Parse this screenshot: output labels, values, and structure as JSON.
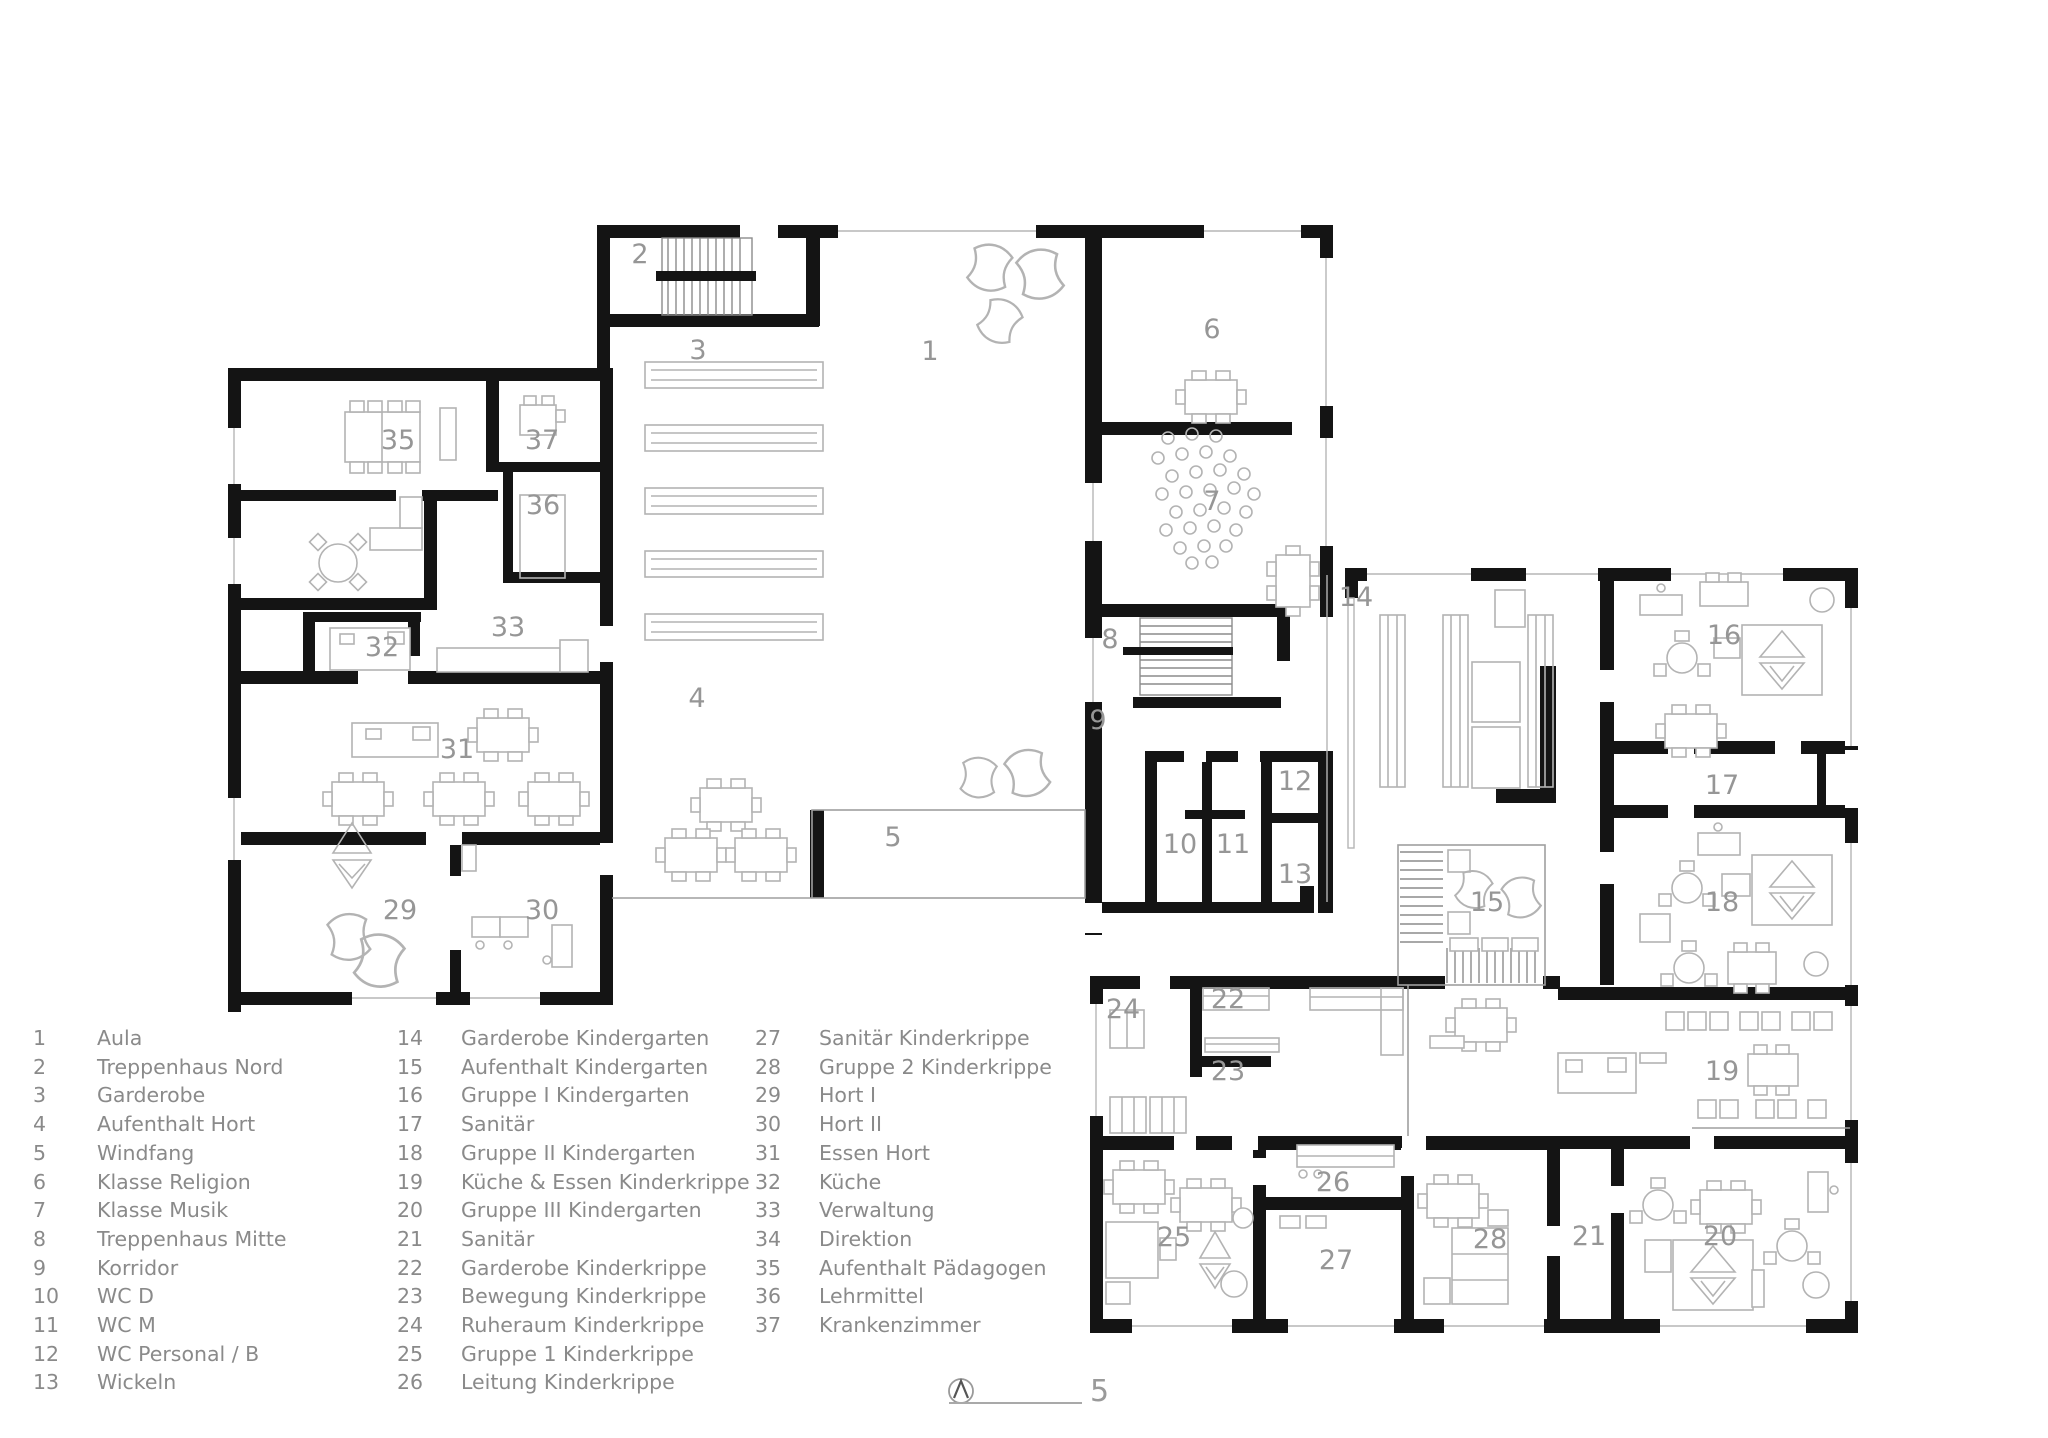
{
  "colors": {
    "wall": "#141414",
    "furniture_line": "#b3b3b3",
    "room_label": "#969696",
    "legend_text": "#8a8a8a",
    "background": "#ffffff"
  },
  "legend": {
    "columns": [
      {
        "items": [
          {
            "num": "1",
            "label": "Aula"
          },
          {
            "num": "2",
            "label": "Treppenhaus Nord"
          },
          {
            "num": "3",
            "label": "Garderobe"
          },
          {
            "num": "4",
            "label": "Aufenthalt Hort"
          },
          {
            "num": "5",
            "label": "Windfang"
          },
          {
            "num": "6",
            "label": "Klasse Religion"
          },
          {
            "num": "7",
            "label": "Klasse Musik"
          },
          {
            "num": "8",
            "label": "Treppenhaus Mitte"
          },
          {
            "num": "9",
            "label": "Korridor"
          },
          {
            "num": "10",
            "label": "WC D"
          },
          {
            "num": "11",
            "label": "WC M"
          },
          {
            "num": "12",
            "label": "WC Personal / B"
          },
          {
            "num": "13",
            "label": "Wickeln"
          }
        ]
      },
      {
        "items": [
          {
            "num": "14",
            "label": "Garderobe Kindergarten"
          },
          {
            "num": "15",
            "label": "Aufenthalt Kindergarten"
          },
          {
            "num": "16",
            "label": "Gruppe I Kindergarten"
          },
          {
            "num": "17",
            "label": "Sanitär"
          },
          {
            "num": "18",
            "label": "Gruppe II Kindergarten"
          },
          {
            "num": "19",
            "label": "Küche & Essen Kinderkrippe"
          },
          {
            "num": "20",
            "label": "Gruppe III Kindergarten"
          },
          {
            "num": "21",
            "label": "Sanitär"
          },
          {
            "num": "22",
            "label": "Garderobe Kinderkrippe"
          },
          {
            "num": "23",
            "label": "Bewegung Kinderkrippe"
          },
          {
            "num": "24",
            "label": "Ruheraum Kinderkrippe"
          },
          {
            "num": "25",
            "label": "Gruppe 1 Kinderkrippe"
          },
          {
            "num": "26",
            "label": "Leitung Kinderkrippe"
          }
        ]
      },
      {
        "items": [
          {
            "num": "27",
            "label": "Sanitär Kinderkrippe"
          },
          {
            "num": "28",
            "label": "Gruppe 2 Kinderkrippe"
          },
          {
            "num": "29",
            "label": "Hort I"
          },
          {
            "num": "30",
            "label": "Hort II"
          },
          {
            "num": "31",
            "label": "Essen Hort"
          },
          {
            "num": "32",
            "label": "Küche"
          },
          {
            "num": "33",
            "label": "Verwaltung"
          },
          {
            "num": "34",
            "label": "Direktion"
          },
          {
            "num": "35",
            "label": "Aufenthalt Pädagogen"
          },
          {
            "num": "36",
            "label": "Lehrmittel"
          },
          {
            "num": "37",
            "label": "Krankenzimmer"
          }
        ]
      }
    ]
  },
  "plan": {
    "room_labels": [
      {
        "num": "1",
        "x": 930,
        "y": 360
      },
      {
        "num": "2",
        "x": 640,
        "y": 263
      },
      {
        "num": "3",
        "x": 698,
        "y": 359
      },
      {
        "num": "4",
        "x": 697,
        "y": 707
      },
      {
        "num": "5",
        "x": 893,
        "y": 846
      },
      {
        "num": "6",
        "x": 1212,
        "y": 338
      },
      {
        "num": "7",
        "x": 1212,
        "y": 510
      },
      {
        "num": "8",
        "x": 1110,
        "y": 648
      },
      {
        "num": "9",
        "x": 1098,
        "y": 729
      },
      {
        "num": "10",
        "x": 1180,
        "y": 853
      },
      {
        "num": "11",
        "x": 1233,
        "y": 853
      },
      {
        "num": "12",
        "x": 1295,
        "y": 790
      },
      {
        "num": "13",
        "x": 1295,
        "y": 883
      },
      {
        "num": "14",
        "x": 1356,
        "y": 606
      },
      {
        "num": "15",
        "x": 1487,
        "y": 911
      },
      {
        "num": "16",
        "x": 1724,
        "y": 644
      },
      {
        "num": "17",
        "x": 1722,
        "y": 794
      },
      {
        "num": "18",
        "x": 1722,
        "y": 911
      },
      {
        "num": "19",
        "x": 1722,
        "y": 1080
      },
      {
        "num": "20",
        "x": 1720,
        "y": 1245
      },
      {
        "num": "21",
        "x": 1589,
        "y": 1245
      },
      {
        "num": "22",
        "x": 1228,
        "y": 1008
      },
      {
        "num": "23",
        "x": 1228,
        "y": 1080
      },
      {
        "num": "24",
        "x": 1123,
        "y": 1018
      },
      {
        "num": "25",
        "x": 1174,
        "y": 1246
      },
      {
        "num": "26",
        "x": 1333,
        "y": 1191
      },
      {
        "num": "27",
        "x": 1336,
        "y": 1269
      },
      {
        "num": "28",
        "x": 1490,
        "y": 1248
      },
      {
        "num": "29",
        "x": 400,
        "y": 919
      },
      {
        "num": "30",
        "x": 542,
        "y": 919
      },
      {
        "num": "31",
        "x": 457,
        "y": 758
      },
      {
        "num": "32",
        "x": 382,
        "y": 656
      },
      {
        "num": "33",
        "x": 508,
        "y": 636
      },
      {
        "num": "35",
        "x": 398,
        "y": 449
      },
      {
        "num": "36",
        "x": 543,
        "y": 514
      },
      {
        "num": "37",
        "x": 542,
        "y": 449
      }
    ]
  },
  "scale_bar": {
    "label": "5"
  },
  "compass": {
    "type": "north-arrow"
  }
}
